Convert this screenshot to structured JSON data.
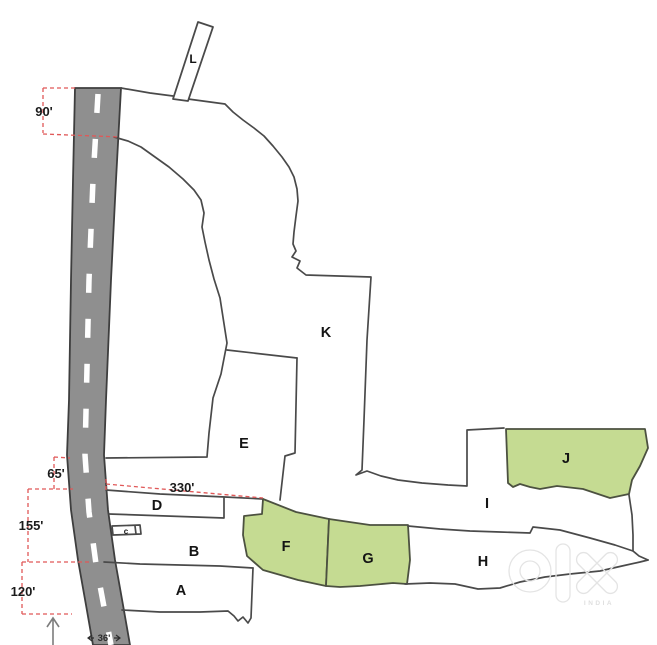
{
  "map": {
    "plots": {
      "A": "A",
      "B": "B",
      "C": "c",
      "D": "D",
      "E": "E",
      "F": "F",
      "G": "G",
      "H": "H",
      "I": "I",
      "J": "J",
      "K": "K",
      "L": "L"
    },
    "highlighted_plots": [
      "F",
      "G",
      "J"
    ],
    "dimensions": {
      "road_frontage_top": "90'",
      "gap_mid": "65'",
      "frontage_mid": "155'",
      "frontage_bottom": "120'",
      "depth_line": "330'",
      "road_width": "36'"
    },
    "watermark": {
      "brand": "olx",
      "country_label": "INDIA"
    },
    "colors": {
      "highlight_green": "#c5db92",
      "road_gray": "#8f8f8f",
      "dimension_red": "#e05858",
      "boundary_gray": "#4a4a4a"
    }
  }
}
